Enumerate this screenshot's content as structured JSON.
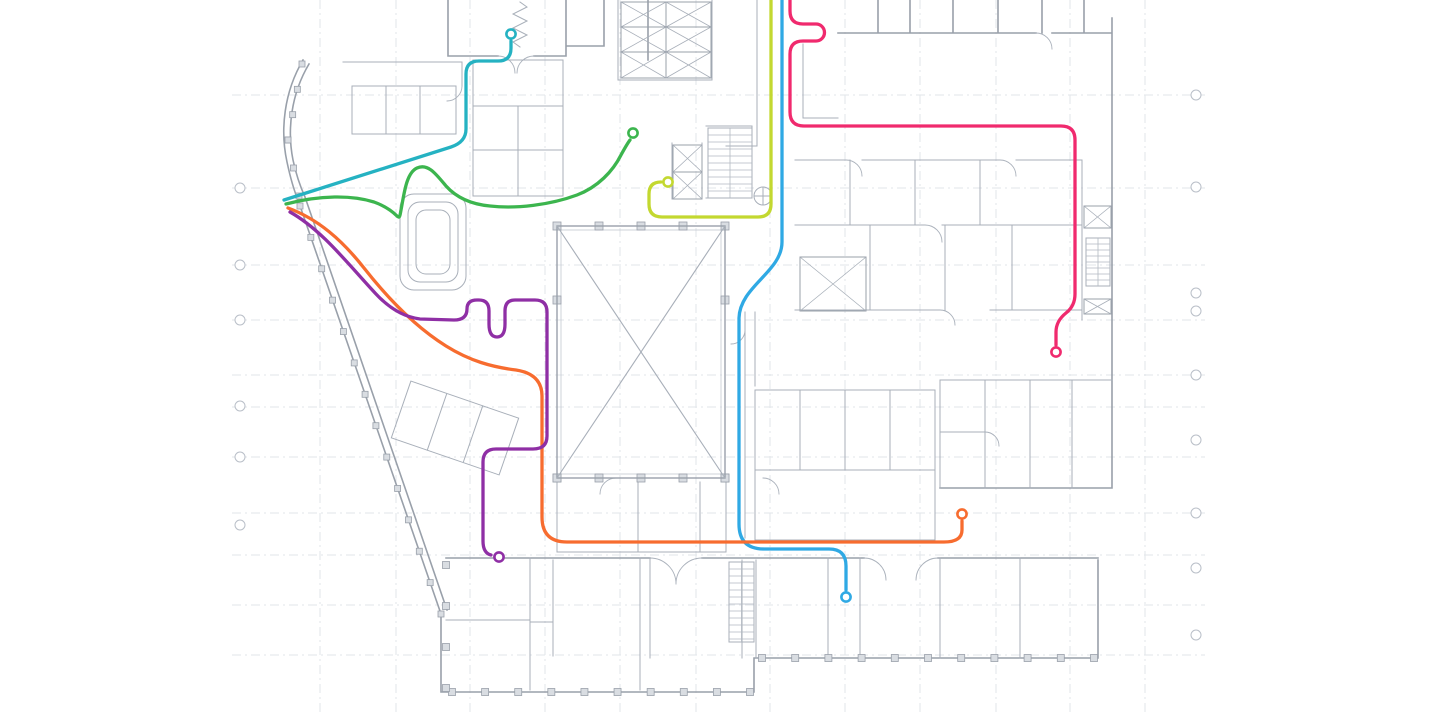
{
  "canvas": {
    "width": 1440,
    "height": 720,
    "background": "#ffffff"
  },
  "floorplan": {
    "wall_color": "#99a0aa",
    "wall_light_color": "#a8afb9",
    "door_color": "#aab1bb",
    "grid_color": "#e2e5ea",
    "marker_color": "#b9bfc8",
    "hatch_color": "#b3b9c2",
    "plan_left_edge": 232,
    "plan_right_edge": 1205,
    "grid_rows_y": [
      95,
      188,
      265,
      320,
      375,
      407,
      457,
      513,
      555,
      605,
      655
    ],
    "grid_cols_x": [
      320,
      396,
      470,
      545,
      620,
      696,
      770,
      845,
      920,
      996,
      1070,
      1145
    ],
    "bubbles_left": {
      "x": 240,
      "ys": [
        188,
        265,
        320,
        406,
        457,
        525
      ]
    },
    "bubbles_right": {
      "x": 1196,
      "ys": [
        95,
        187,
        293,
        311,
        375,
        440,
        513,
        568,
        635
      ]
    },
    "colonnades": [
      {
        "x1": 452,
        "y1": 692,
        "x2": 750,
        "y2": 692,
        "n": 10,
        "s": 7
      },
      {
        "x1": 762,
        "y1": 658,
        "x2": 1094,
        "y2": 658,
        "n": 11,
        "s": 7
      },
      {
        "x1": 300,
        "y1": 206,
        "x2": 441,
        "y2": 614,
        "n": 14,
        "s": 6
      },
      {
        "x1": 302,
        "y1": 64,
        "x2": 288,
        "y2": 140,
        "n": 4,
        "s": 6
      },
      {
        "x1": 288,
        "y1": 140,
        "x2": 299,
        "y2": 196,
        "n": 3,
        "s": 6
      },
      {
        "x1": 557,
        "y1": 226,
        "x2": 725,
        "y2": 226,
        "n": 5,
        "s": 8
      },
      {
        "x1": 557,
        "y1": 478,
        "x2": 725,
        "y2": 478,
        "n": 5,
        "s": 8
      },
      {
        "x1": 557,
        "y1": 300,
        "x2": 557,
        "y2": 478,
        "n": 2,
        "s": 8
      },
      {
        "x1": 725,
        "y1": 300,
        "x2": 725,
        "y2": 478,
        "n": 2,
        "s": 8
      },
      {
        "x1": 446,
        "y1": 565,
        "x2": 446,
        "y2": 688,
        "n": 4,
        "s": 7
      }
    ],
    "stairs": [
      {
        "x": 708,
        "y": 128,
        "w": 44,
        "h": 70,
        "step": 7
      },
      {
        "x": 729,
        "y": 562,
        "w": 25,
        "h": 80,
        "step": 7
      },
      {
        "x": 1086,
        "y": 238,
        "w": 24,
        "h": 48,
        "step": 6
      }
    ],
    "xboxes": [
      {
        "x": 557,
        "y": 226,
        "w": 168,
        "h": 252,
        "sw": 1.4
      },
      {
        "x": 800,
        "y": 257,
        "w": 66,
        "h": 54,
        "sw": 1
      },
      {
        "x": 621,
        "y": 2,
        "w": 45,
        "h": 25,
        "sw": 1
      },
      {
        "x": 666,
        "y": 2,
        "w": 45,
        "h": 25,
        "sw": 1
      },
      {
        "x": 621,
        "y": 27,
        "w": 45,
        "h": 25,
        "sw": 1
      },
      {
        "x": 666,
        "y": 27,
        "w": 45,
        "h": 25,
        "sw": 1
      },
      {
        "x": 621,
        "y": 52,
        "w": 45,
        "h": 26,
        "sw": 1
      },
      {
        "x": 666,
        "y": 52,
        "w": 45,
        "h": 26,
        "sw": 1
      },
      {
        "x": 673,
        "y": 145,
        "w": 29,
        "h": 27,
        "sw": 1
      },
      {
        "x": 673,
        "y": 172,
        "w": 29,
        "h": 27,
        "sw": 1
      },
      {
        "x": 1084,
        "y": 206,
        "w": 27,
        "h": 22,
        "sw": 1
      },
      {
        "x": 1084,
        "y": 299,
        "w": 27,
        "h": 15,
        "sw": 1
      }
    ]
  },
  "routes": {
    "stroke_width": 3.3,
    "marker_radius": 4.6,
    "marker_stroke_width": 2.6,
    "marker_fill": "#ffffff",
    "items": [
      {
        "id": "teal",
        "label": "teal-route",
        "color": "#25B2C2",
        "path": "M 284,200 L 451,147 Q 466,142 466,129 L 466,74 Q 466,61 479,61 L 498,61 Q 511,61 511,48 L 511,41",
        "marker": {
          "x": 511,
          "y": 34
        }
      },
      {
        "id": "green",
        "label": "green-route",
        "color": "#3CB54E",
        "path": "M 286,204 C 320,195 352,195 374,202 C 385,206 392,211 397,216 C 400,219 400,215 401,210 C 404,195 406,173 417,168 C 428,163 436,174 446,186 C 455,196 468,204 490,206 C 516,209 550,205 577,195 C 598,187 613,171 621,155 Q 627,144 630,140",
        "marker": {
          "x": 633,
          "y": 133
        }
      },
      {
        "id": "lime",
        "label": "lime-route",
        "color": "#C3D830",
        "path": "M 771,0 L 771,204 Q 771,217 758,217 L 662,217 Q 649,217 649,204 L 649,194 Q 649,182 661,182",
        "marker": {
          "x": 668,
          "y": 182
        }
      },
      {
        "id": "blue",
        "label": "blue-route",
        "color": "#2FA9E4",
        "path": "M 782,0 L 782,242 C 782,272 740,286 739,318 L 739,524 Q 739,549 764,549 L 829,549 Q 846,549 846,566 L 846,590",
        "marker": {
          "x": 846,
          "y": 597
        }
      },
      {
        "id": "orange",
        "label": "orange-route",
        "color": "#F76C2F",
        "path": "M 288,208 C 318,219 342,240 364,268 C 386,296 414,326 446,346 C 470,361 492,367 516,370 Q 542,374 542,396 L 542,517 Q 542,542 567,542 L 944,542 Q 962,542 962,530 L 962,521",
        "marker": {
          "x": 962,
          "y": 514
        }
      },
      {
        "id": "purple",
        "label": "purple-route",
        "color": "#8F2FA5",
        "path": "M 290,212 C 322,230 348,264 376,294 C 390,309 404,317 420,319 L 454,320 Q 467,320 467,309 Q 467,300 477,300 L 479,300 Q 489,300 489,311 L 489,324 Q 489,337 497,337 Q 505,337 505,324 L 505,311 Q 505,300 515,300 L 535,300 Q 547,300 547,312 L 547,436 Q 547,449 533,449 L 496,449 Q 483,449 483,462 L 483,541 Q 483,553 491,555",
        "marker": {
          "x": 499,
          "y": 557
        }
      },
      {
        "id": "pink",
        "label": "pink-route",
        "color": "#F02A6E",
        "path": "M 790,0 L 790,11 Q 790,24 803,24 L 816,24 A 8.5,8.5 0 0 1 816,41 L 803,41 Q 790,41 790,54 L 790,112 Q 790,126 804,126 L 1061,126 Q 1075,126 1075,140 L 1075,294 Q 1075,306 1066,313 Q 1056,321 1056,332 L 1056,345",
        "marker": {
          "x": 1056,
          "y": 352
        }
      }
    ]
  }
}
